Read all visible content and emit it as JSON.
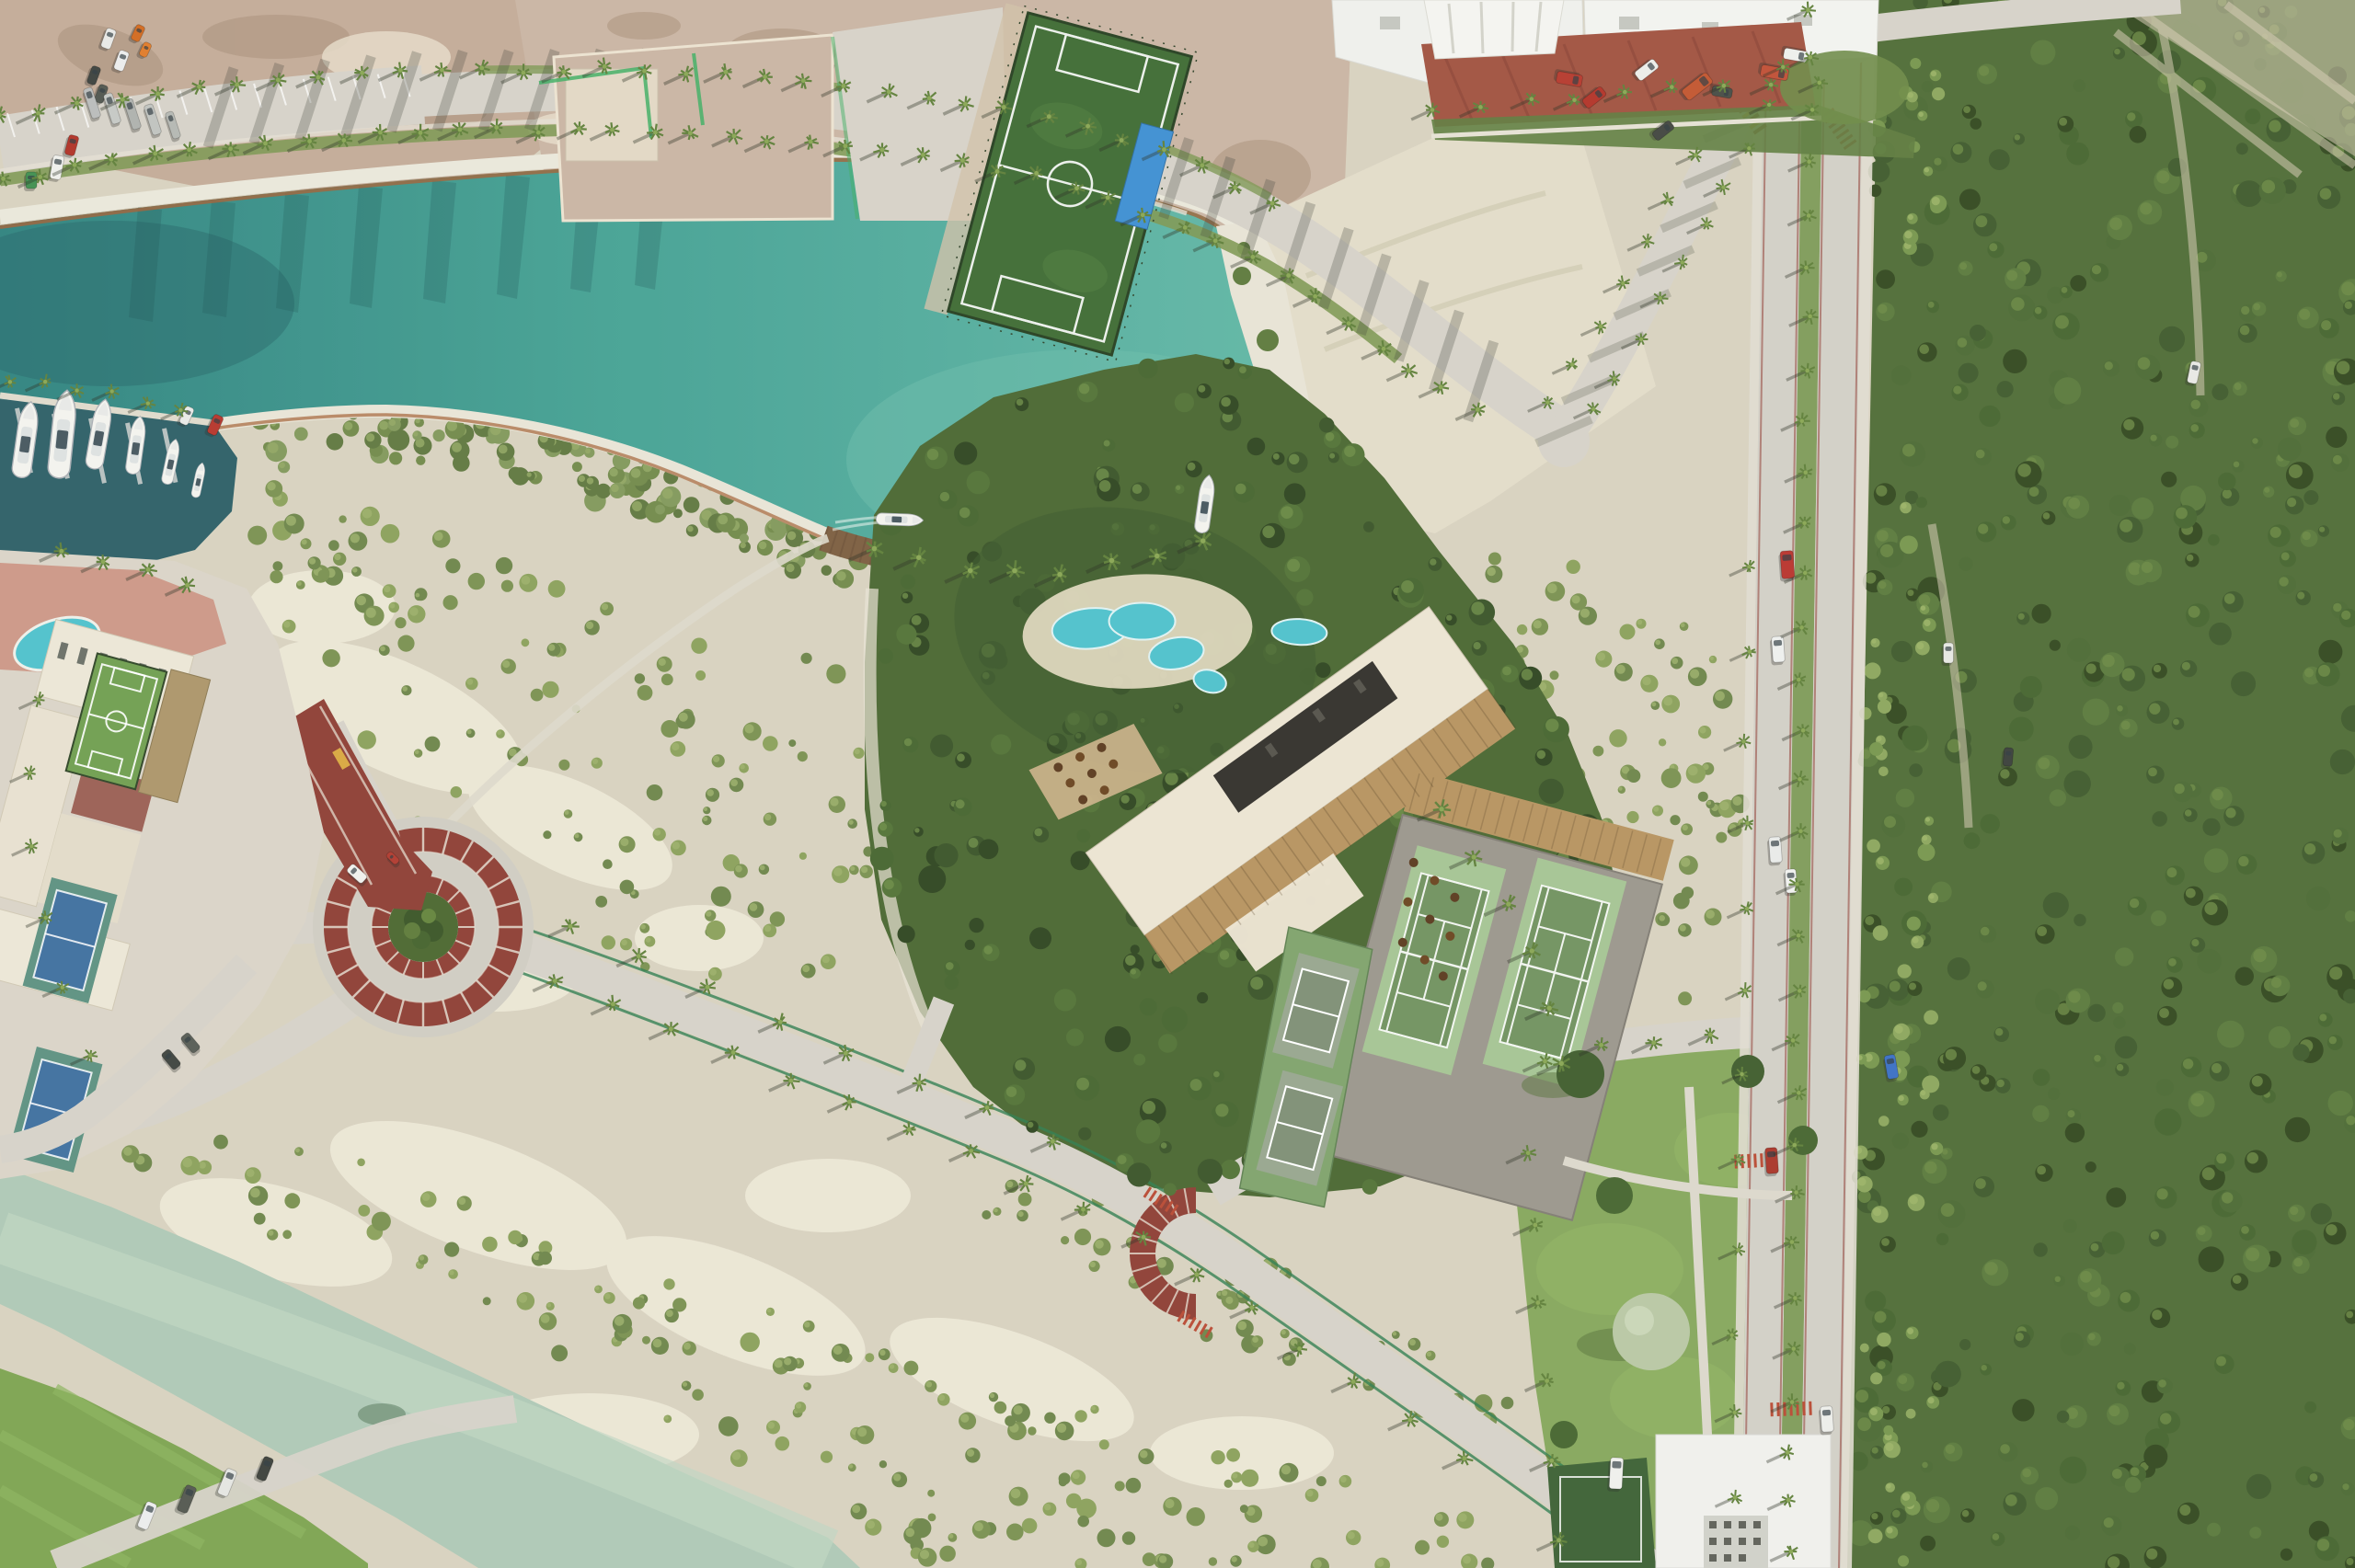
{
  "meta": {
    "title": "Top-down aerial photograph of a coastal resort development with marina canal, tennis club rendering, roads and mangrove forest",
    "view": "orthographic drone top-down",
    "time_of_day": "late afternoon (long shadows toward south-west)"
  },
  "palette": {
    "sand": "#d8d2bf",
    "sand-bright": "#efead9",
    "dirt": "#c3ab97",
    "dirt-dark": "#a18872",
    "road": "#d6d2c8",
    "sidewalk": "#e3dfd2",
    "canal": "#44a193",
    "canal-deep": "#2f827e",
    "canal-light": "#63b8a6",
    "marina": "#2c5f66",
    "river": "#aec8b5",
    "rock": "#e9e6da",
    "rust": "#a35f33",
    "forest": "#4f6c36",
    "garden": "#4a6731",
    "lawn": "#85a75b",
    "verge": "#7d9752",
    "median": "#7f9b59",
    "cream": "#ece4d2",
    "roof-dark": "#32302a",
    "wood": "#b6935f",
    "pool": "#4ec1cb",
    "platform": "#9a968b",
    "court-apron": "#a5c493",
    "court": "#70925f",
    "court-blue": "#3e6f9e",
    "brick": "#8e3e34",
    "clay": "#a0523f",
    "field-green": "#3e6b33"
  },
  "scene": {
    "marina": {
      "moored_boats": 6
    },
    "canal": {
      "boats_anchored": 2,
      "wooden_piers": 1
    },
    "resort_rendering": {
      "tennis_courts": 2,
      "pickleball_courts": 2,
      "lagoon_pools": 4,
      "restaurant_umbrella_tables": 17
    },
    "left_resort": {
      "rooftop_futsal_courts": 1,
      "blue_tennis_courts": 2,
      "pools": 2
    },
    "plazas": {
      "red_brick_roundabout": 1,
      "red_brick_half_arc": 1
    },
    "soccer_fields": 2,
    "vehicles_visible_approx": 40,
    "roads": {
      "palm_lined_boulevards": 2,
      "divided_avenue": 1
    }
  }
}
